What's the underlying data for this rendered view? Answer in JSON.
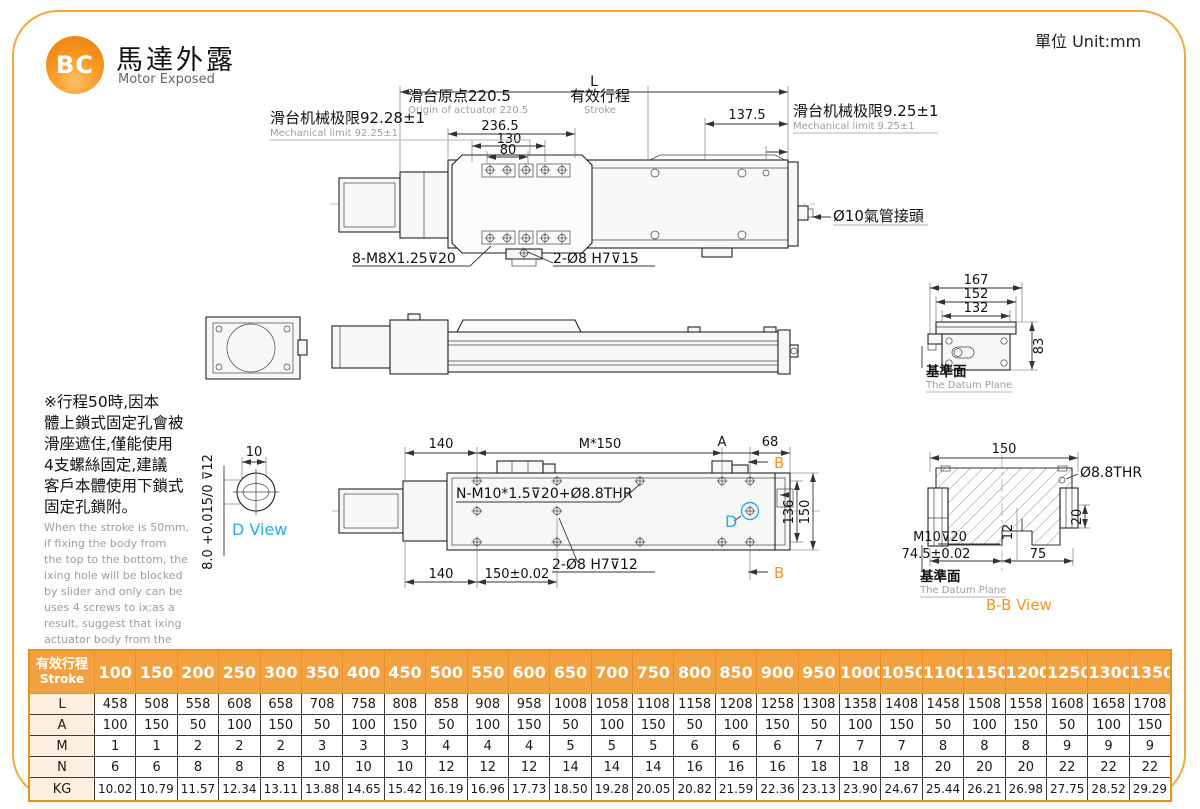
{
  "header": {
    "logo": "BC",
    "title": "馬達外露",
    "subtitle": "Motor Exposed",
    "unit": "單位 Unit:mm"
  },
  "colors": {
    "accent_orange": "#F1A140",
    "border_orange": "#F6A53F",
    "table_label_bg": "#FCEFE0",
    "view_label_cyan": "#29ABE2",
    "section_label_orange": "#F7941D",
    "secondary_text_gray": "#9E9E9E"
  },
  "top_view": {
    "dim_l": "L",
    "origin_zh": "滑台原点220.5",
    "origin_en": "Origin of actuator 220.5",
    "stroke_zh": "有效行程",
    "stroke_en": "Stroke",
    "dim_137_5": "137.5",
    "dim_236_5": "236.5",
    "dim_130": "130",
    "dim_80": "80",
    "limit_left_zh": "滑台机械极限92.28±1",
    "limit_left_en": "Mechanical limit 92.25±1",
    "limit_right_zh": "滑台机械极限9.25±1",
    "limit_right_en": "Mechanical limit 9.25±1",
    "air_fitting": "Ø10氣管接頭",
    "screw_label": "8-M8X1.25⊽20",
    "pin_label": "2-Ø8 H7⊽15"
  },
  "end_view": {
    "dim_167": "167",
    "dim_152": "152",
    "dim_132": "132",
    "dim_83": "83",
    "datum_zh": "基準面",
    "datum_en": "The Datum Plane"
  },
  "note": {
    "zh": "※行程50時,因本\n體上鎖式固定孔會被\n滑座遮住,僅能使用\n4支螺絲固定,建議\n客戶本體使用下鎖式\n固定孔鎖附。",
    "en": "When the stroke is 50mm,\nif fixing the body from\nthe top to the bottom, the\nixing hole will be blocked\nby slider and only can be\nuses 4 screws to ix;as a\nresult, suggest that ixing\nactuator body from the\nbottom to the top."
  },
  "d_view": {
    "dim_10": "10",
    "tolerance": "8.0 +0.015/0 ⊽12",
    "label": "D View"
  },
  "bottom_view": {
    "dim_140_a": "140",
    "dim_m150": "M*150",
    "label_a": "A",
    "dim_68": "68",
    "label_b": "B",
    "thread_label": "N-M10*1.5⊽20+Ø8.8THR",
    "dim_136": "136",
    "dim_150": "150",
    "pin_label": "2-Ø8 H7⊽12",
    "dim_140_b": "140",
    "dim_150_tol": "150±0.02",
    "label_d": "D"
  },
  "bb_view": {
    "dim_150": "150",
    "thr_label": "Ø8.8THR",
    "dim_20": "20",
    "dim_12": "12",
    "m10_label": "M10⊽20",
    "dim_74_5": "74.5±0.02",
    "dim_75": "75",
    "datum_zh": "基準面",
    "datum_en": "The Datum Plane",
    "label": "B-B View"
  },
  "table": {
    "header_zh": "有效行程",
    "header_en": "Stroke",
    "strokes": [
      100,
      150,
      200,
      250,
      300,
      350,
      400,
      450,
      500,
      550,
      600,
      650,
      700,
      750,
      800,
      850,
      900,
      950,
      1000,
      1050,
      1100,
      1150,
      1200,
      1250,
      1300,
      1350
    ],
    "rows": [
      {
        "label": "L",
        "values": [
          458,
          508,
          558,
          608,
          658,
          708,
          758,
          808,
          858,
          908,
          958,
          1008,
          1058,
          1108,
          1158,
          1208,
          1258,
          1308,
          1358,
          1408,
          1458,
          1508,
          1558,
          1608,
          1658,
          1708
        ]
      },
      {
        "label": "A",
        "values": [
          100,
          150,
          50,
          100,
          150,
          50,
          100,
          150,
          50,
          100,
          150,
          50,
          100,
          150,
          50,
          100,
          150,
          50,
          100,
          150,
          50,
          100,
          150,
          50,
          100,
          150
        ]
      },
      {
        "label": "M",
        "values": [
          1,
          1,
          2,
          2,
          2,
          3,
          3,
          3,
          4,
          4,
          4,
          5,
          5,
          5,
          6,
          6,
          6,
          7,
          7,
          7,
          8,
          8,
          8,
          9,
          9,
          9
        ]
      },
      {
        "label": "N",
        "values": [
          6,
          6,
          8,
          8,
          8,
          10,
          10,
          10,
          12,
          12,
          12,
          14,
          14,
          14,
          16,
          16,
          16,
          18,
          18,
          18,
          20,
          20,
          20,
          22,
          22,
          22
        ]
      },
      {
        "label": "KG",
        "values": [
          "10.02",
          "10.79",
          "11.57",
          "12.34",
          "13.11",
          "13.88",
          "14.65",
          "15.42",
          "16.19",
          "16.96",
          "17.73",
          "18.50",
          "19.28",
          "20.05",
          "20.82",
          "21.59",
          "22.36",
          "23.13",
          "23.90",
          "24.67",
          "25.44",
          "26.21",
          "26.98",
          "27.75",
          "28.52",
          "29.29"
        ]
      }
    ]
  }
}
